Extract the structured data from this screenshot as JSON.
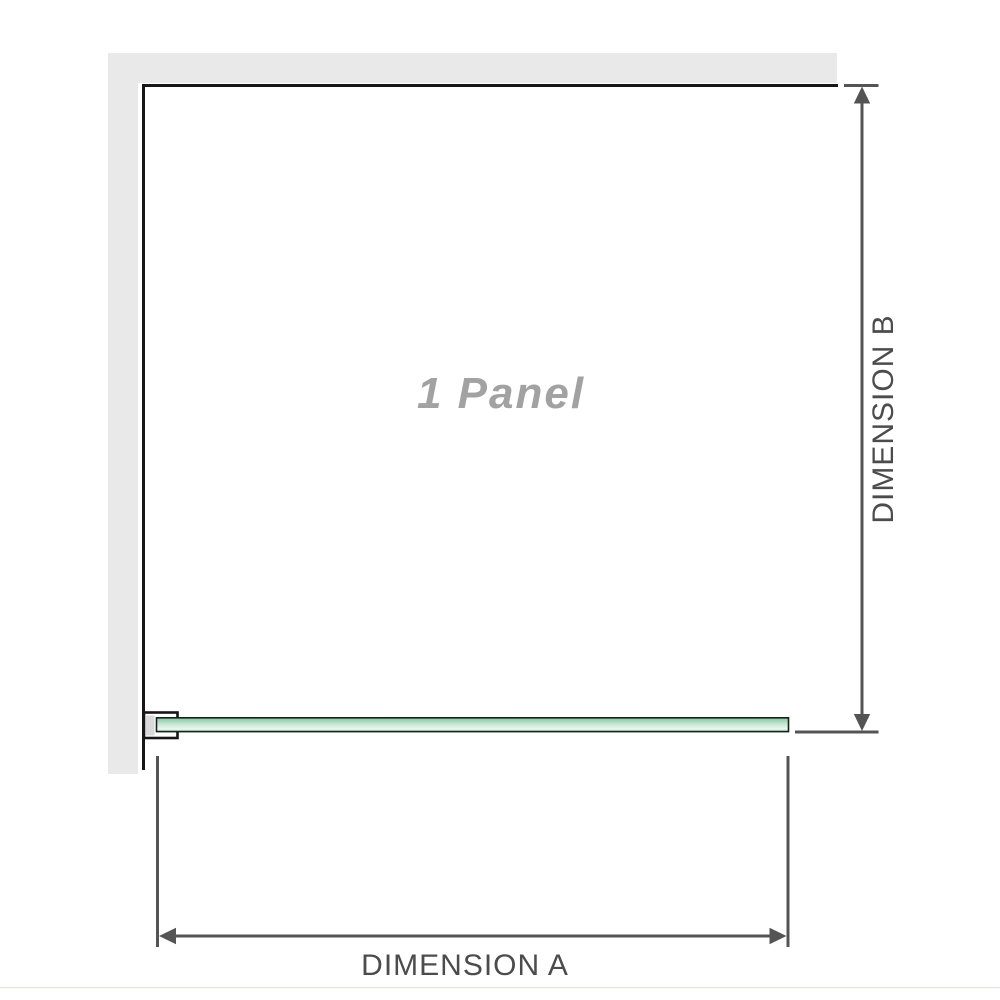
{
  "diagram": {
    "panel_label": "1 Panel",
    "dimension_labels": {
      "a": "DIMENSION A",
      "b": "DIMENSION B"
    }
  },
  "colors": {
    "wall_fill": "#e9e9e9",
    "outline": "#161616",
    "glass_stroke": "#16211a",
    "glass_green_top": "#86c6a0",
    "glass_green_mid": "#c2e7d1",
    "glass_green_light": "#eef8f2",
    "glass_green_bottom": "#9fd2b6",
    "bracket_fill": "#ffffff",
    "bracket_pad_fill": "#d9d9d9",
    "dimension_line": "#545454",
    "dimension_text": "#4c4c4c",
    "panel_label_color": "#a2a2a2",
    "baseline": "#e9e7e1"
  }
}
